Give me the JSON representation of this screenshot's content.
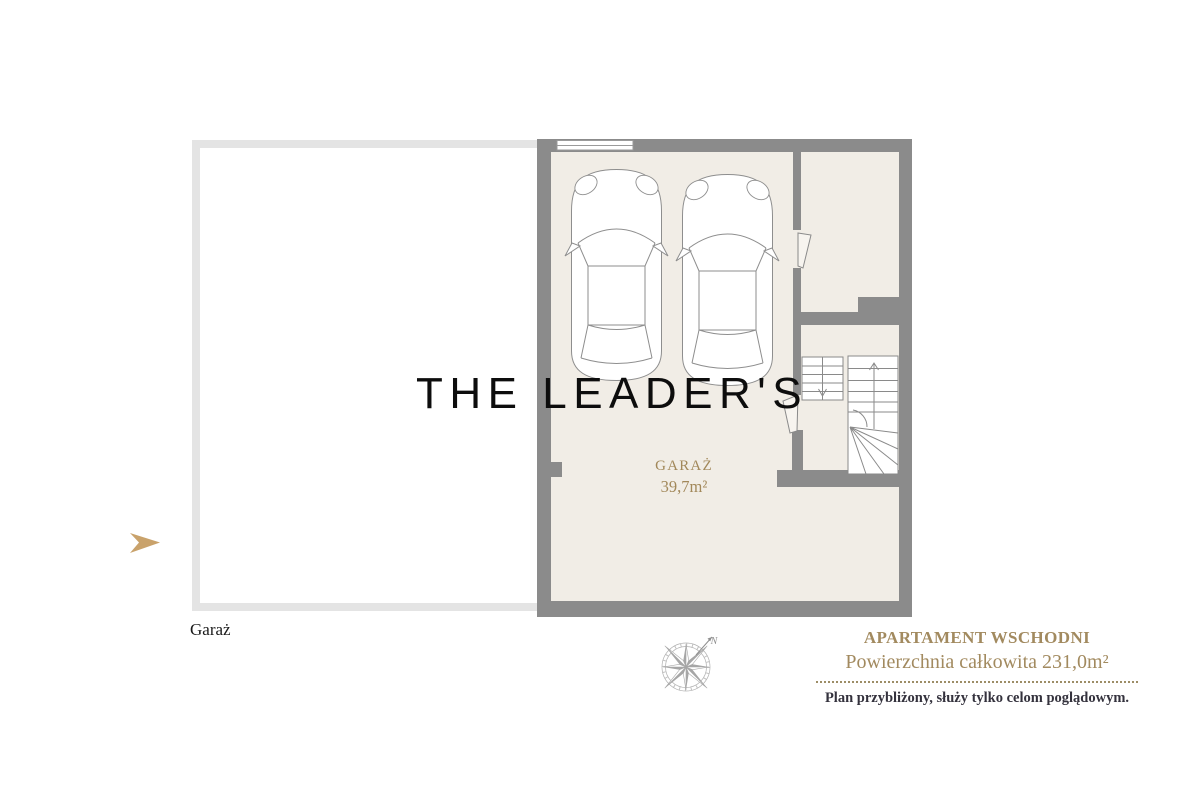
{
  "colors": {
    "wall_gray": "#8b8b8b",
    "floor_beige": "#f1ede6",
    "outline_gray": "#e4e4e4",
    "gold_text": "#a28a5f",
    "arrow_gold": "#c9a26b",
    "disclaimer_dark": "#34323d"
  },
  "watermark": {
    "text": "THE LEADER'S"
  },
  "exterior": {
    "left_area_label": "Garaż"
  },
  "plan": {
    "room_name": "GARAŻ",
    "room_area": "39,7m²"
  },
  "compass": {
    "north_label": "N"
  },
  "info_panel": {
    "title": "APARTAMENT WSCHODNI",
    "subtitle": "Powierzchnia całkowita 231,0m²",
    "disclaimer": "Plan przybliżony, służy tylko celom poglądowym."
  }
}
